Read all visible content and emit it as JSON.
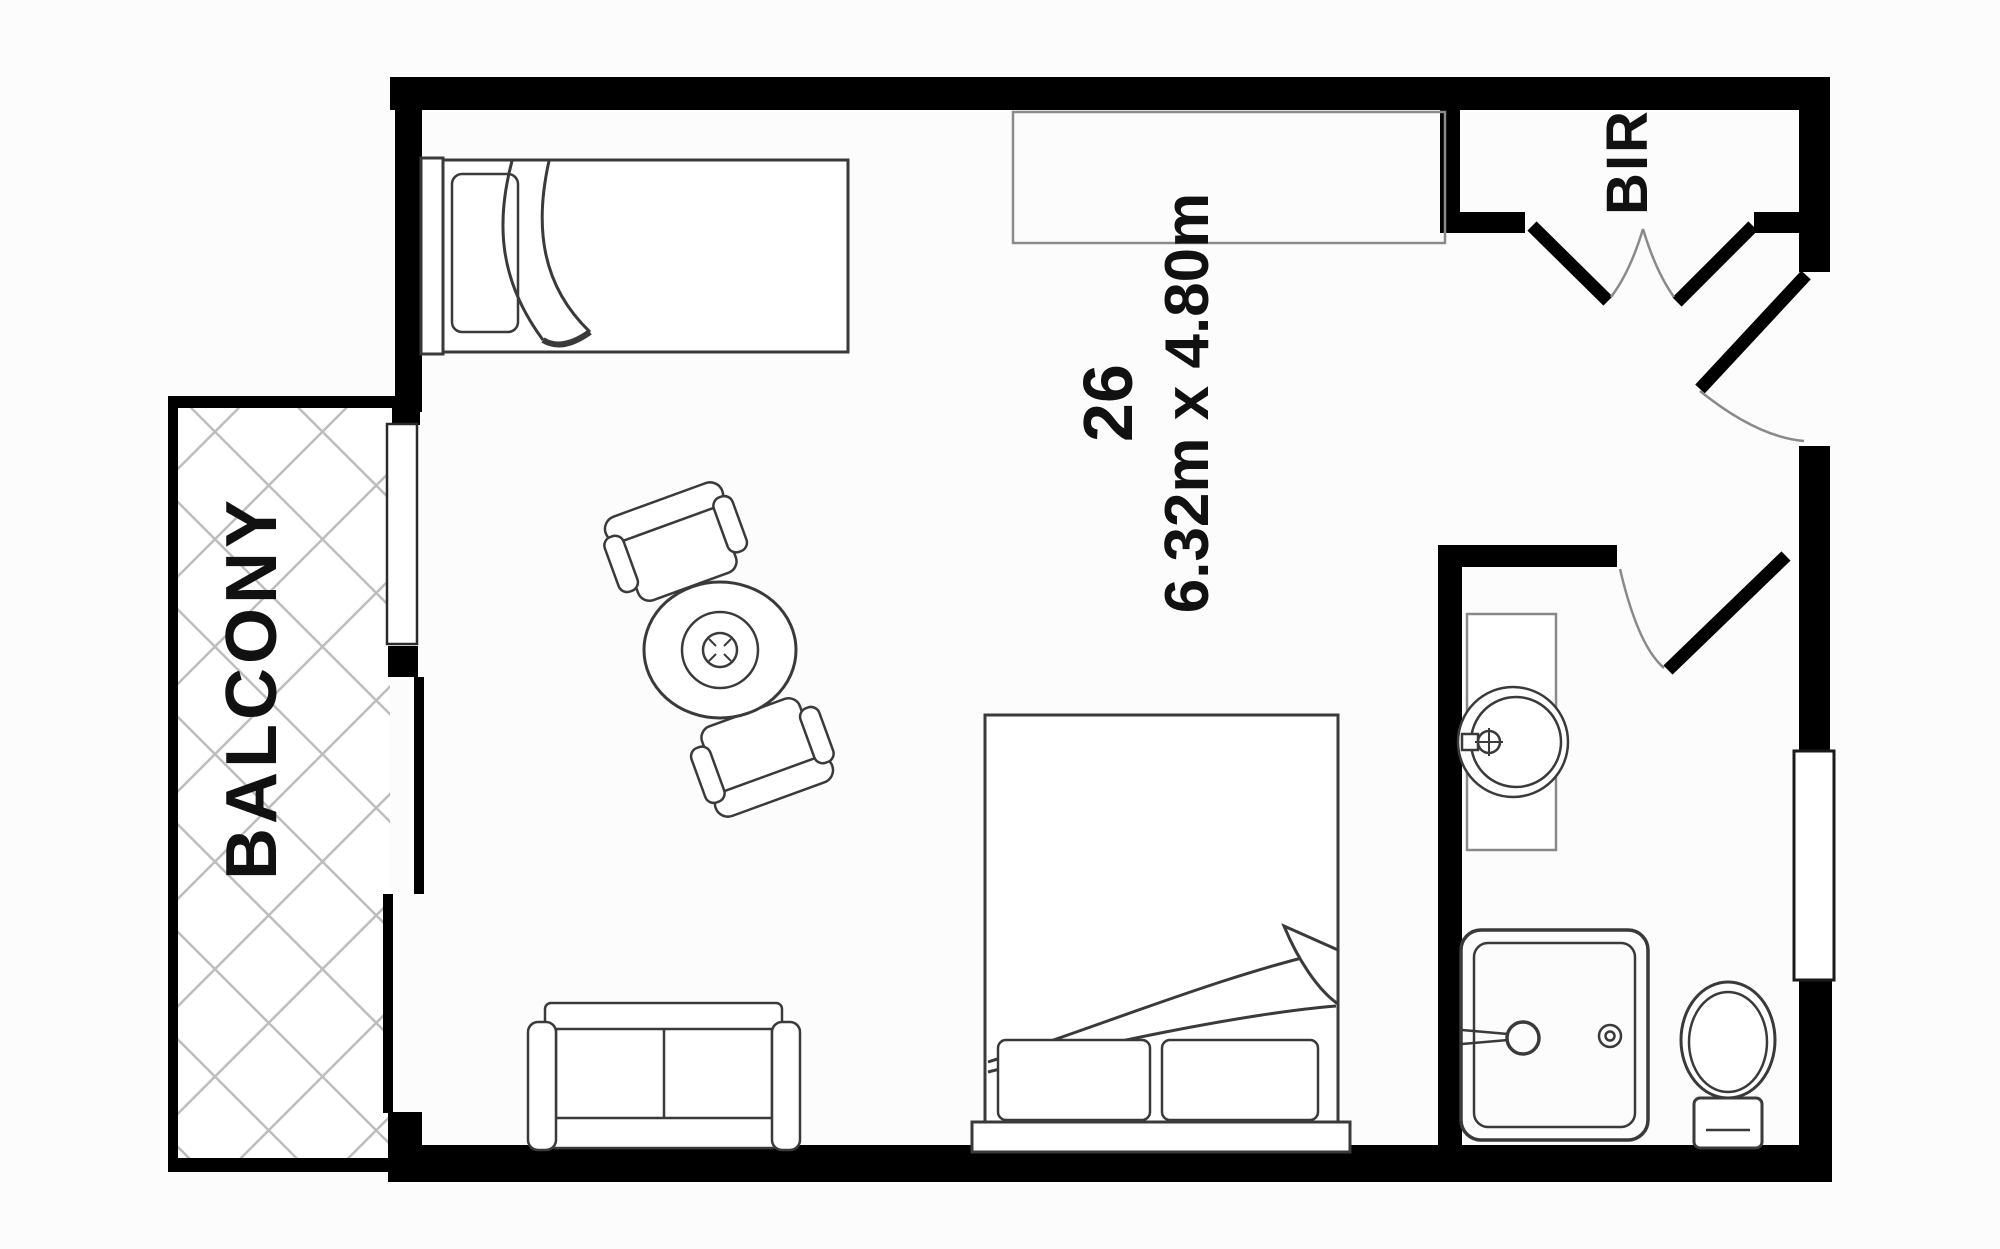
{
  "labels": {
    "balcony": "BALCONY",
    "robe": "BIR",
    "unit_number": "26",
    "room_dimensions": "6.32m x 4.80m"
  },
  "colors": {
    "wall": "#000000",
    "furniture_outline": "#3a3a3a",
    "thin_line": "#8a8a8a",
    "hatch": "#bdbdbd",
    "background": "#fcfcfc",
    "text": "#111111"
  }
}
